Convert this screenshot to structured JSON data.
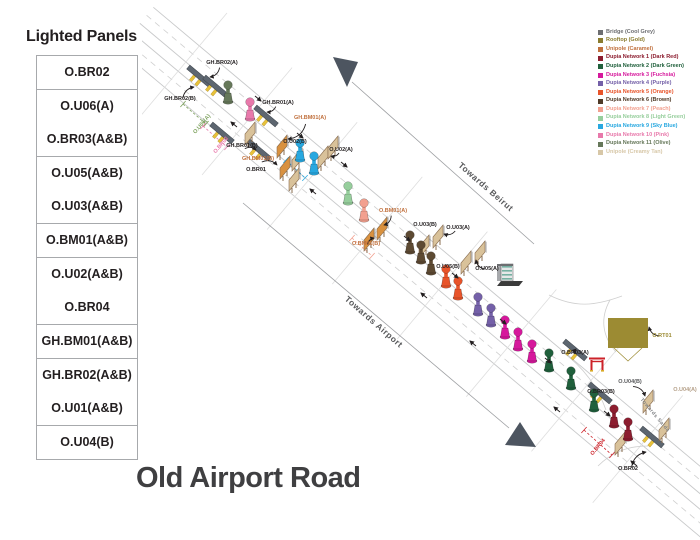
{
  "page": {
    "title": "Old Airport Road"
  },
  "sidebar": {
    "title": "Lighted Panels",
    "groups": [
      [
        "O.BR02"
      ],
      [
        "O.U06(A)",
        "O.BR03(A&B)"
      ],
      [
        "O.U05(A&B)",
        "O.U03(A&B)"
      ],
      [
        "O.BM01(A&B)"
      ],
      [
        "O.U02(A&B)",
        "O.BR04"
      ],
      [
        "GH.BM01(A&B)"
      ],
      [
        "GH.BR02(A&B)",
        "O.U01(A&B)"
      ],
      [
        "O.U04(B)"
      ]
    ]
  },
  "legend": {
    "items": [
      {
        "label": "Bridge (Cool Grey)",
        "color": "#6d6e71"
      },
      {
        "label": "Rooftop (Gold)",
        "color": "#8a7c2f"
      },
      {
        "label": "Unipole (Caramel)",
        "color": "#c0703d"
      },
      {
        "label": "Dupia Network 1 (Dark Red)",
        "color": "#8c1d2f"
      },
      {
        "label": "Dupia Network 2 (Dark Green)",
        "color": "#20603c"
      },
      {
        "label": "Dupia Network 3 (Fuchsia)",
        "color": "#d6189c"
      },
      {
        "label": "Dupia Network 4 (Purple)",
        "color": "#7460a8"
      },
      {
        "label": "Dupia Network 5 (Orange)",
        "color": "#e8542a"
      },
      {
        "label": "Dupia Network 6 (Brown)",
        "color": "#4f3a27"
      },
      {
        "label": "Dupia Network 7 (Peach)",
        "color": "#f2a08f"
      },
      {
        "label": "Dupia Network 8 (Light Green)",
        "color": "#96ce9c"
      },
      {
        "label": "Dupia Network 9 (Sky Blue)",
        "color": "#28a8e0"
      },
      {
        "label": "Dupia Network 10 (Pink)",
        "color": "#e879ab"
      },
      {
        "label": "Dupia Network 11 (Olive)",
        "color": "#66785a"
      },
      {
        "label": "Unipole (Creamy Tan)",
        "color": "#d7c7a7"
      }
    ]
  },
  "map": {
    "direction_labels": [
      {
        "text": "Towards Beirut",
        "x": 484,
        "y": 189,
        "angle": 41,
        "size": 8.5,
        "color": "#58595b"
      },
      {
        "text": "Towards Airport",
        "x": 372,
        "y": 324,
        "angle": 41,
        "size": 8.5,
        "color": "#58595b"
      },
      {
        "text": "Towards Saida",
        "x": 654,
        "y": 416,
        "angle": 50,
        "size": 5,
        "color": "#808285"
      }
    ],
    "panel_labels": [
      {
        "t": "GH.BR02(A)",
        "x": 222,
        "y": 64,
        "a": [
          210,
          77
        ]
      },
      {
        "t": "GH.BR02(B)",
        "x": 180,
        "y": 100,
        "a": [
          194,
          87
        ]
      },
      {
        "t": "GH.BR01(A)",
        "x": 278,
        "y": 104,
        "a": [
          267,
          112
        ]
      },
      {
        "t": "GH.BM01(A)",
        "x": 310,
        "y": 119,
        "c": "#c0703d",
        "a": [
          288,
          139
        ]
      },
      {
        "t": "GH.BR01(B)",
        "x": 242,
        "y": 147,
        "a": [
          256,
          150
        ]
      },
      {
        "t": "GH.BM01(B)",
        "x": 258,
        "y": 160,
        "c": "#c0703d",
        "a": [
          277,
          165
        ]
      },
      {
        "t": "O.BR01",
        "x": 256,
        "y": 171
      },
      {
        "t": "O.U06(A)",
        "x": 203,
        "y": 125,
        "c": "#7ba05b",
        "r": -50
      },
      {
        "t": "O.BR02",
        "x": 222,
        "y": 146,
        "c": "#e879ab",
        "r": -50
      },
      {
        "t": "O.U02(A)",
        "x": 341,
        "y": 151,
        "a": [
          331,
          156
        ]
      },
      {
        "t": "O.U02(B)",
        "x": 295,
        "y": 143
      },
      {
        "t": "O.BM01(A)",
        "x": 393,
        "y": 212,
        "c": "#c0703d",
        "a": [
          384,
          225
        ]
      },
      {
        "t": "O.BM01(B)",
        "x": 366,
        "y": 245,
        "c": "#c0703d",
        "a": [
          374,
          238
        ]
      },
      {
        "t": "O.U03(B)",
        "x": 425,
        "y": 226
      },
      {
        "t": "O.U03(A)",
        "x": 458,
        "y": 229,
        "a": [
          444,
          234
        ]
      },
      {
        "t": "O.U05(B)",
        "x": 448,
        "y": 268
      },
      {
        "t": "O.U05(A)",
        "x": 487,
        "y": 270,
        "a": [
          476,
          260
        ]
      },
      {
        "t": "O.BR03(A)",
        "x": 575,
        "y": 354,
        "a": [
          576,
          349
        ]
      },
      {
        "t": "O.BR03(B)",
        "x": 601,
        "y": 393
      },
      {
        "t": "O.BR04",
        "x": 599,
        "y": 448,
        "c": "#cc2229",
        "r": -50
      },
      {
        "t": "O.U04(B)",
        "x": 630,
        "y": 383,
        "c": "#58595b",
        "a": [
          645,
          396
        ]
      },
      {
        "t": "O.U04(A)",
        "x": 685,
        "y": 391,
        "c": "#b5a089"
      },
      {
        "t": "O.BR02",
        "x": 628,
        "y": 470,
        "a": [
          646,
          452
        ]
      },
      {
        "t": "O.RT01",
        "x": 662,
        "y": 337,
        "c": "#9c8b33",
        "a": [
          649,
          327
        ]
      }
    ],
    "dupias": [
      {
        "x": 228,
        "y": 96,
        "c": "#66785a"
      },
      {
        "x": 250,
        "y": 113,
        "c": "#e879ab"
      },
      {
        "x": 300,
        "y": 154,
        "c": "#28a8e0"
      },
      {
        "x": 314,
        "y": 167,
        "c": "#28a8e0"
      },
      {
        "x": 348,
        "y": 197,
        "c": "#96ce9c"
      },
      {
        "x": 364,
        "y": 214,
        "c": "#f2a08f"
      },
      {
        "x": 410,
        "y": 246,
        "c": "#5d4a33"
      },
      {
        "x": 421,
        "y": 256,
        "c": "#5d4a33"
      },
      {
        "x": 431,
        "y": 267,
        "c": "#5d4a33"
      },
      {
        "x": 446,
        "y": 280,
        "c": "#e8542a"
      },
      {
        "x": 458,
        "y": 292,
        "c": "#e8542a"
      },
      {
        "x": 478,
        "y": 308,
        "c": "#7460a8"
      },
      {
        "x": 491,
        "y": 319,
        "c": "#7460a8"
      },
      {
        "x": 505,
        "y": 331,
        "c": "#d6189c"
      },
      {
        "x": 518,
        "y": 343,
        "c": "#d6189c"
      },
      {
        "x": 532,
        "y": 355,
        "c": "#d6189c"
      },
      {
        "x": 549,
        "y": 364,
        "c": "#20603c"
      },
      {
        "x": 571,
        "y": 382,
        "c": "#20603c"
      },
      {
        "x": 594,
        "y": 404,
        "c": "#20603c"
      },
      {
        "x": 614,
        "y": 420,
        "c": "#8c1d2f"
      },
      {
        "x": 628,
        "y": 433,
        "c": "#8c1d2f"
      }
    ],
    "billboards": [
      {
        "x": 250,
        "y": 133,
        "c": "#d9c29a"
      },
      {
        "x": 282,
        "y": 146,
        "c": "#d9913f"
      },
      {
        "x": 297,
        "y": 159,
        "c": "#d9c29a"
      },
      {
        "x": 323,
        "y": 157,
        "c": "#d9c29a"
      },
      {
        "x": 333,
        "y": 147,
        "c": "#d9c29a"
      },
      {
        "x": 285,
        "y": 167,
        "c": "#d9913f"
      },
      {
        "x": 294,
        "y": 179,
        "c": "#d9c29a"
      },
      {
        "x": 382,
        "y": 228,
        "c": "#d9913f"
      },
      {
        "x": 369,
        "y": 239,
        "c": "#d9913f"
      },
      {
        "x": 438,
        "y": 236,
        "c": "#d9c29a"
      },
      {
        "x": 424,
        "y": 246,
        "c": "#d9c29a"
      },
      {
        "x": 480,
        "y": 252,
        "c": "#d9c29a"
      },
      {
        "x": 466,
        "y": 262,
        "c": "#d9c29a"
      },
      {
        "x": 648,
        "y": 401,
        "c": "#d9c29a"
      },
      {
        "x": 664,
        "y": 429,
        "c": "#d9c29a"
      },
      {
        "x": 620,
        "y": 443,
        "c": "#d9c29a"
      }
    ],
    "bridges": [
      {
        "x": 199,
        "y": 76
      },
      {
        "x": 215,
        "y": 86
      },
      {
        "x": 266,
        "y": 116
      },
      {
        "x": 259,
        "y": 150
      },
      {
        "x": 222,
        "y": 133
      },
      {
        "x": 575,
        "y": 350
      },
      {
        "x": 600,
        "y": 393
      },
      {
        "x": 652,
        "y": 437
      }
    ],
    "brackets": [
      {
        "color": "#7ba05b",
        "x1": 183,
        "y1": 104,
        "x2": 206,
        "y2": 124
      },
      {
        "color": "#e879ab",
        "x1": 203,
        "y1": 126,
        "x2": 227,
        "y2": 147
      },
      {
        "color": "#cc2229",
        "x1": 584,
        "y1": 430,
        "x2": 612,
        "y2": 455
      },
      {
        "color": "#f2a08f",
        "x1": 352,
        "y1": 238,
        "x2": 372,
        "y2": 256
      },
      {
        "color": "#28a8e0",
        "x1": 286,
        "y1": 160,
        "x2": 305,
        "y2": 178
      }
    ],
    "rooftop": {
      "x": 608,
      "y": 318,
      "w": 40,
      "h": 30,
      "color": "#9c8b33"
    },
    "gate": {
      "x": 597,
      "y": 369,
      "color": "#cc2229"
    },
    "building": {
      "x": 507,
      "y": 276
    }
  }
}
